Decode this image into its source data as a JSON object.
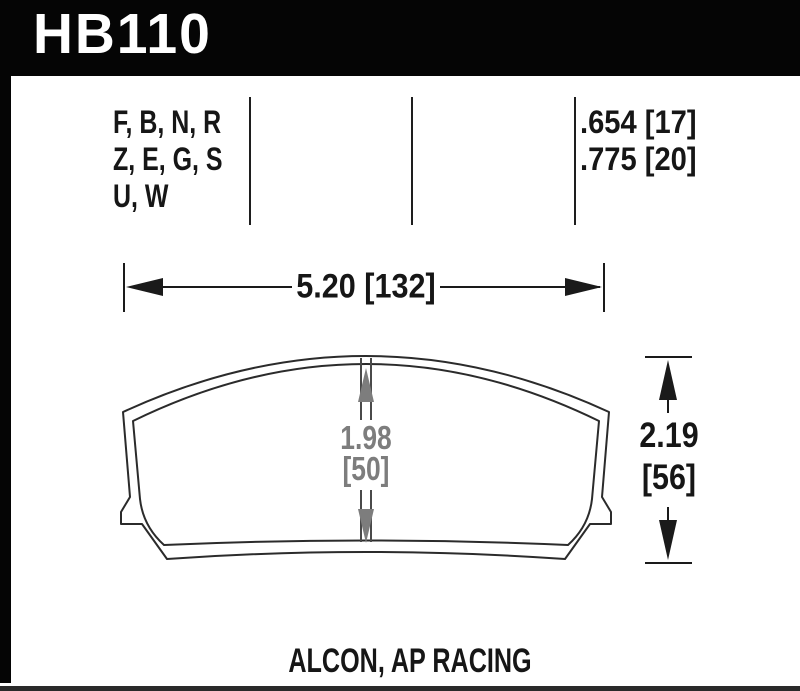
{
  "header": {
    "part_number": "HB110",
    "bar_color": "#050505",
    "text_color": "#ffffff"
  },
  "spec_table": {
    "compound_codes": {
      "lines": [
        "F, B, N, R",
        "Z, E, G, S",
        "U, W"
      ]
    },
    "pad_thickness": {
      "lines": [
        ".654 [17]",
        ".775 [20]"
      ]
    }
  },
  "dimensions": {
    "width": {
      "label": "5.20 [132]"
    },
    "overall_height": {
      "value": "2.19",
      "bracket": "[56]"
    },
    "center_height": {
      "value": "1.98",
      "bracket": "[50]"
    }
  },
  "footer": {
    "applications": "ALCON, AP RACING"
  },
  "colors": {
    "line_color": "#1e1e1e",
    "outline_color": "#2b2b2b",
    "dimension_gray": "#7d7d7d"
  }
}
